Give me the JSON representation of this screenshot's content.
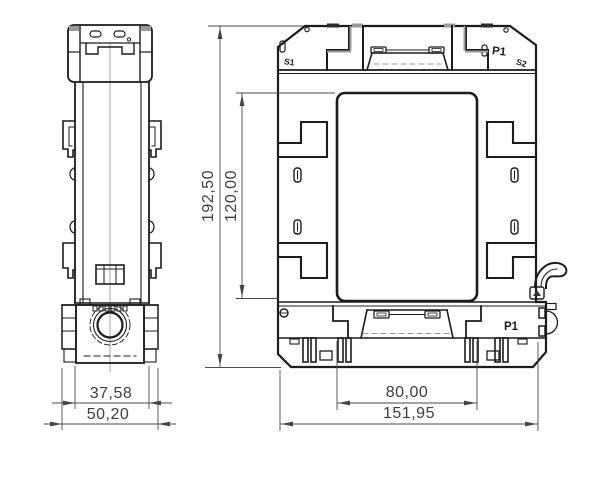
{
  "drawing_type": "technical-dimension-drawing",
  "views": {
    "side_view": {
      "name": "side view"
    },
    "front_view": {
      "labels": {
        "s1": "S1",
        "p1_top": "P1",
        "s2": "S2",
        "p1_bottom": "P1"
      }
    }
  },
  "dimensions": {
    "overall_height": "192,50",
    "window_height": "120,00",
    "body_width": "37,58",
    "overall_depth": "50,20",
    "window_width": "80,00",
    "overall_width": "151,95"
  },
  "colors": {
    "background": "#ffffff",
    "edge": "#1c1c1c",
    "accent_gray": "#9a9a9a",
    "dimension": "#454545"
  }
}
